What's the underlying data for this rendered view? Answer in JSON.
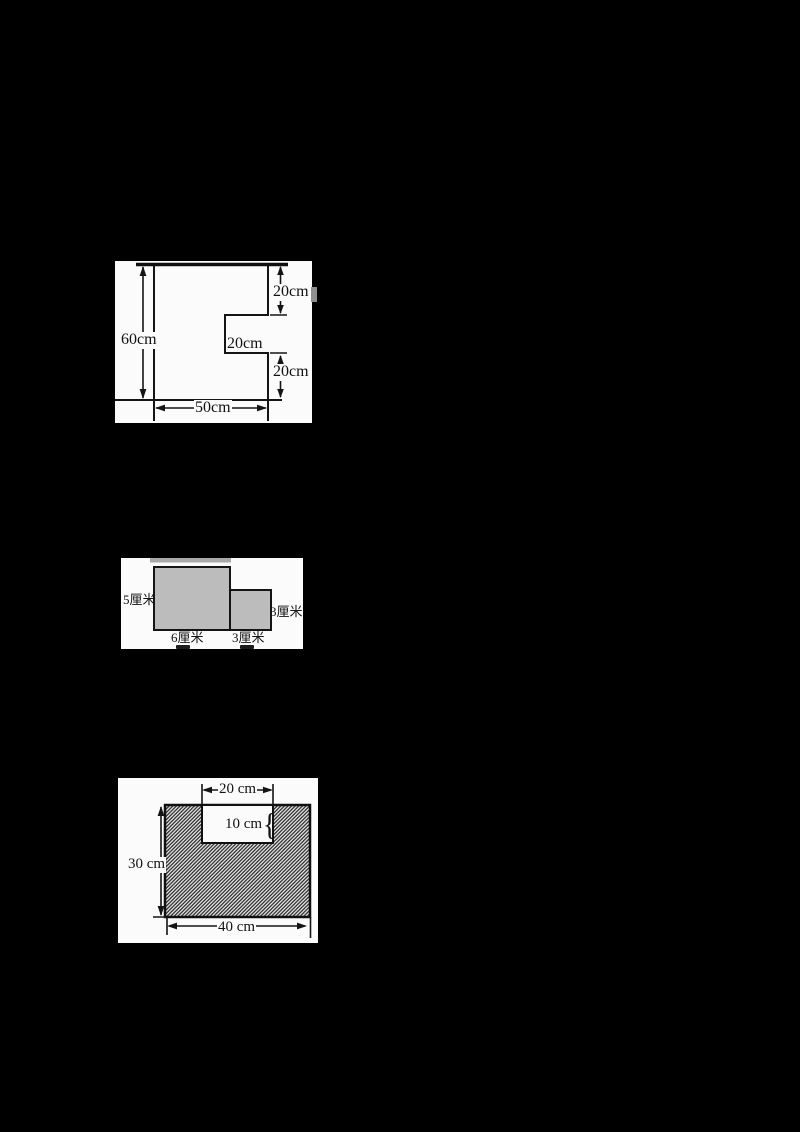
{
  "background": "#000000",
  "figure1": {
    "description": "rectangle 50cm x 60cm with rectangular notch cut from right side",
    "labels": {
      "height_total": "60cm",
      "segment_top_right": "20cm",
      "notch_depth": "20cm",
      "segment_bottom_right": "20cm",
      "width_bottom": "50cm"
    }
  },
  "figure2": {
    "description": "large gray rectangle 6x5 with small gray rectangle 3x3 attached at right, bottom aligned",
    "fill_color": "#bcbcbc",
    "labels": {
      "large_rect_height": "5厘米",
      "small_rect_height": "3厘米",
      "large_rect_width": "6厘米",
      "small_rect_width": "3厘米"
    }
  },
  "figure3": {
    "description": "hatched rectangle 40cm x 30cm with white notch 20cm x 10cm cut into top edge",
    "labels": {
      "notch_width": "20 cm",
      "notch_height": "10 cm",
      "height_total": "30 cm",
      "width_total": "40 cm",
      "brace": "{"
    }
  }
}
